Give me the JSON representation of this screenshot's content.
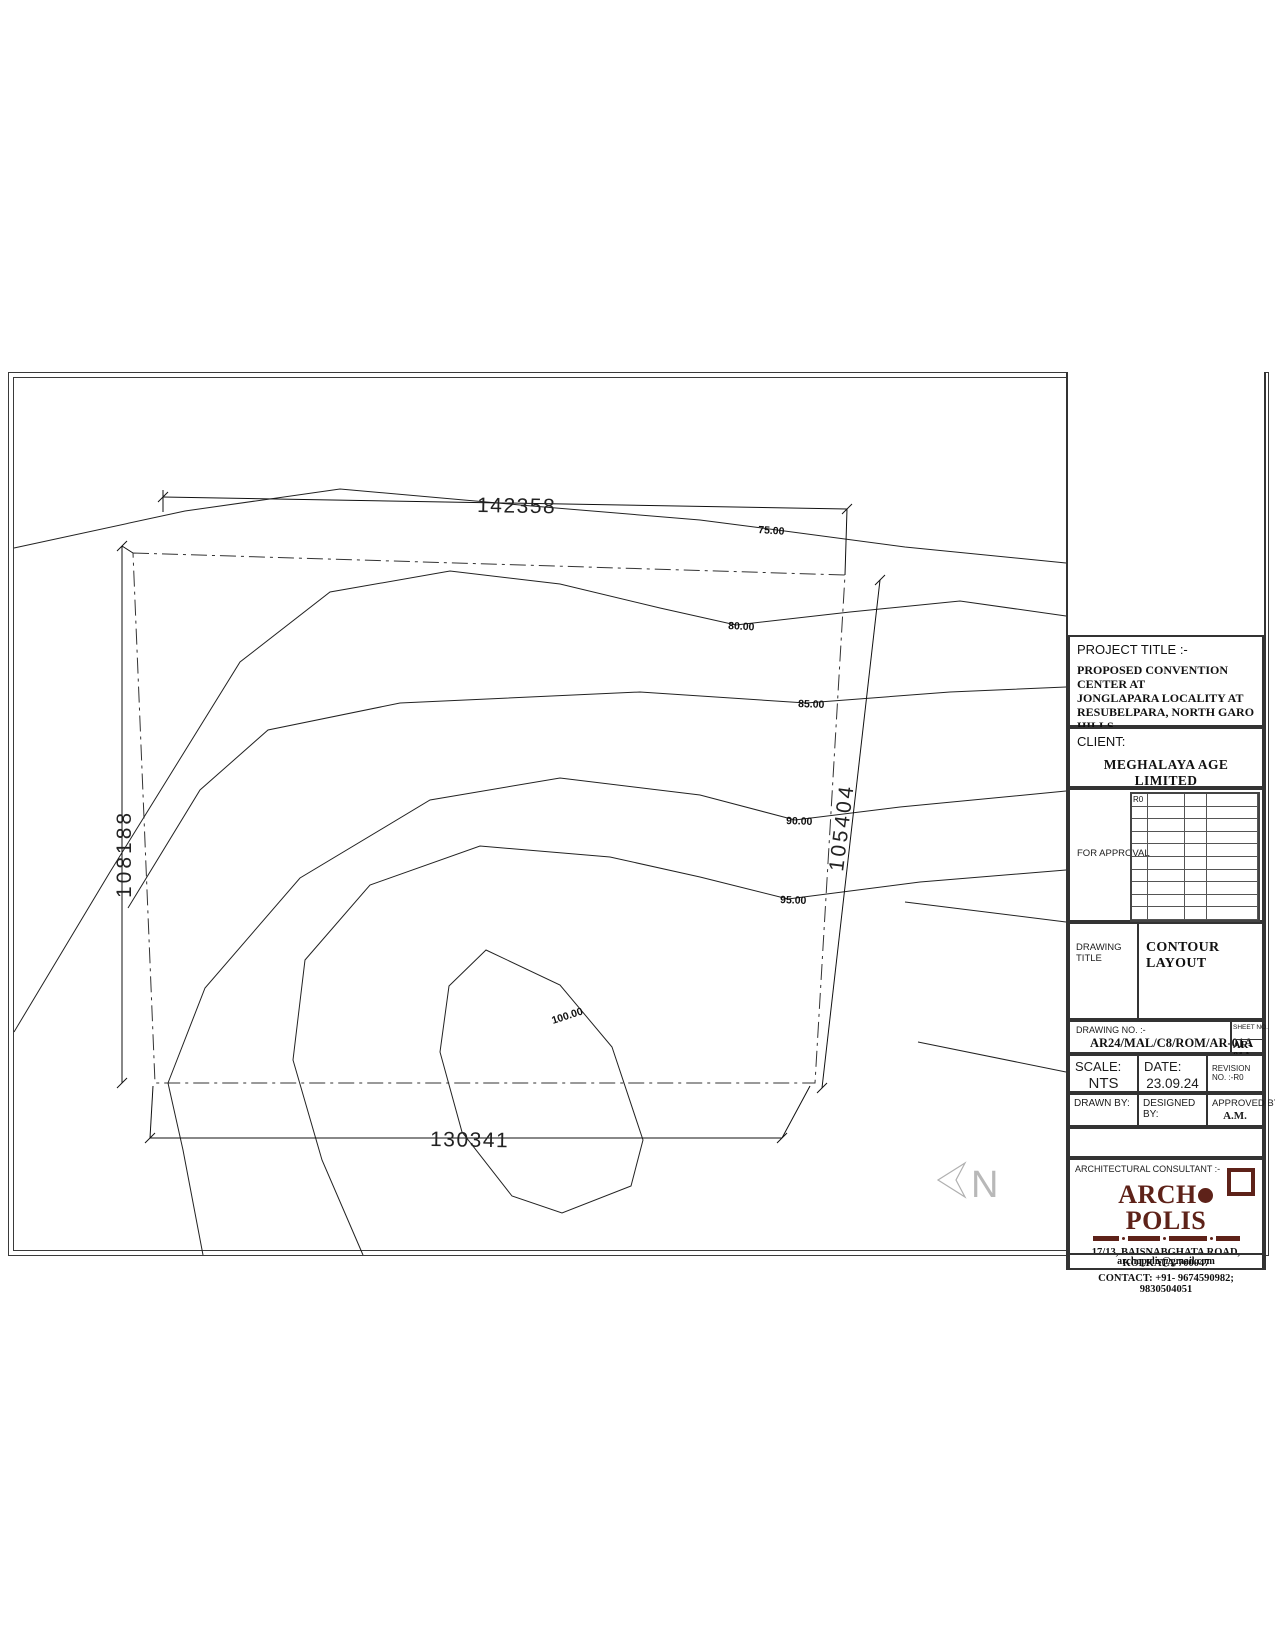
{
  "sheet": {
    "project_title_label": "PROJECT TITLE :-",
    "project_title_lines": [
      "PROPOSED CONVENTION CENTER AT",
      "JONGLAPARA LOCALITY AT",
      "RESUBELPARA, NORTH GARO HILLS,",
      "MEGHALAYA- PHASE 1"
    ],
    "client_label": "CLIENT:",
    "client_name": "MEGHALAYA AGE LIMITED",
    "approval": {
      "label": "FOR APPROVAL",
      "revision_cell": "R0"
    },
    "drawing_title_label": "DRAWING TITLE",
    "drawing_title": "CONTOUR LAYOUT",
    "drawing_no_label": "DRAWING NO. :-",
    "drawing_no": "AR24/MAL/C8/ROM/AR-01A",
    "sheet_no_label": "SHEET NO.",
    "sheet_no": "AR-01A",
    "scale_label": "SCALE:",
    "scale_value": "NTS",
    "date_label": "DATE:",
    "date_value": "23.09.24",
    "revision_no_label": "REVISION NO. :-R0",
    "drawn_by_label": "DRAWN BY:",
    "designed_by_label": "DESIGNED BY:",
    "approved_by_label": "APPROVED BY :-",
    "approved_by_value": "A.M.",
    "consultant_label": "ARCHITECTURAL CONSULTANT :-",
    "logo_text_left": "ARCH",
    "logo_text_right": "POLIS",
    "logo_color": "#5e2219",
    "consultant_address": "17/13, BAISNABGHATA ROAD, KOLKATA-700047",
    "consultant_contact": "CONTACT: +91- 9674590982; 9830504051",
    "consultant_email": "archopolis@gmail.com"
  },
  "drawing": {
    "dimensions": {
      "top": "142358",
      "left": "108188",
      "right": "105404",
      "bottom": "130341"
    },
    "contour_labels": [
      "75.00",
      "80.00",
      "85.00",
      "90.00",
      "95.00",
      "100.00"
    ],
    "north_label": "N",
    "north_color": "#b0b0b0",
    "line_color": "#1c1c1c"
  }
}
